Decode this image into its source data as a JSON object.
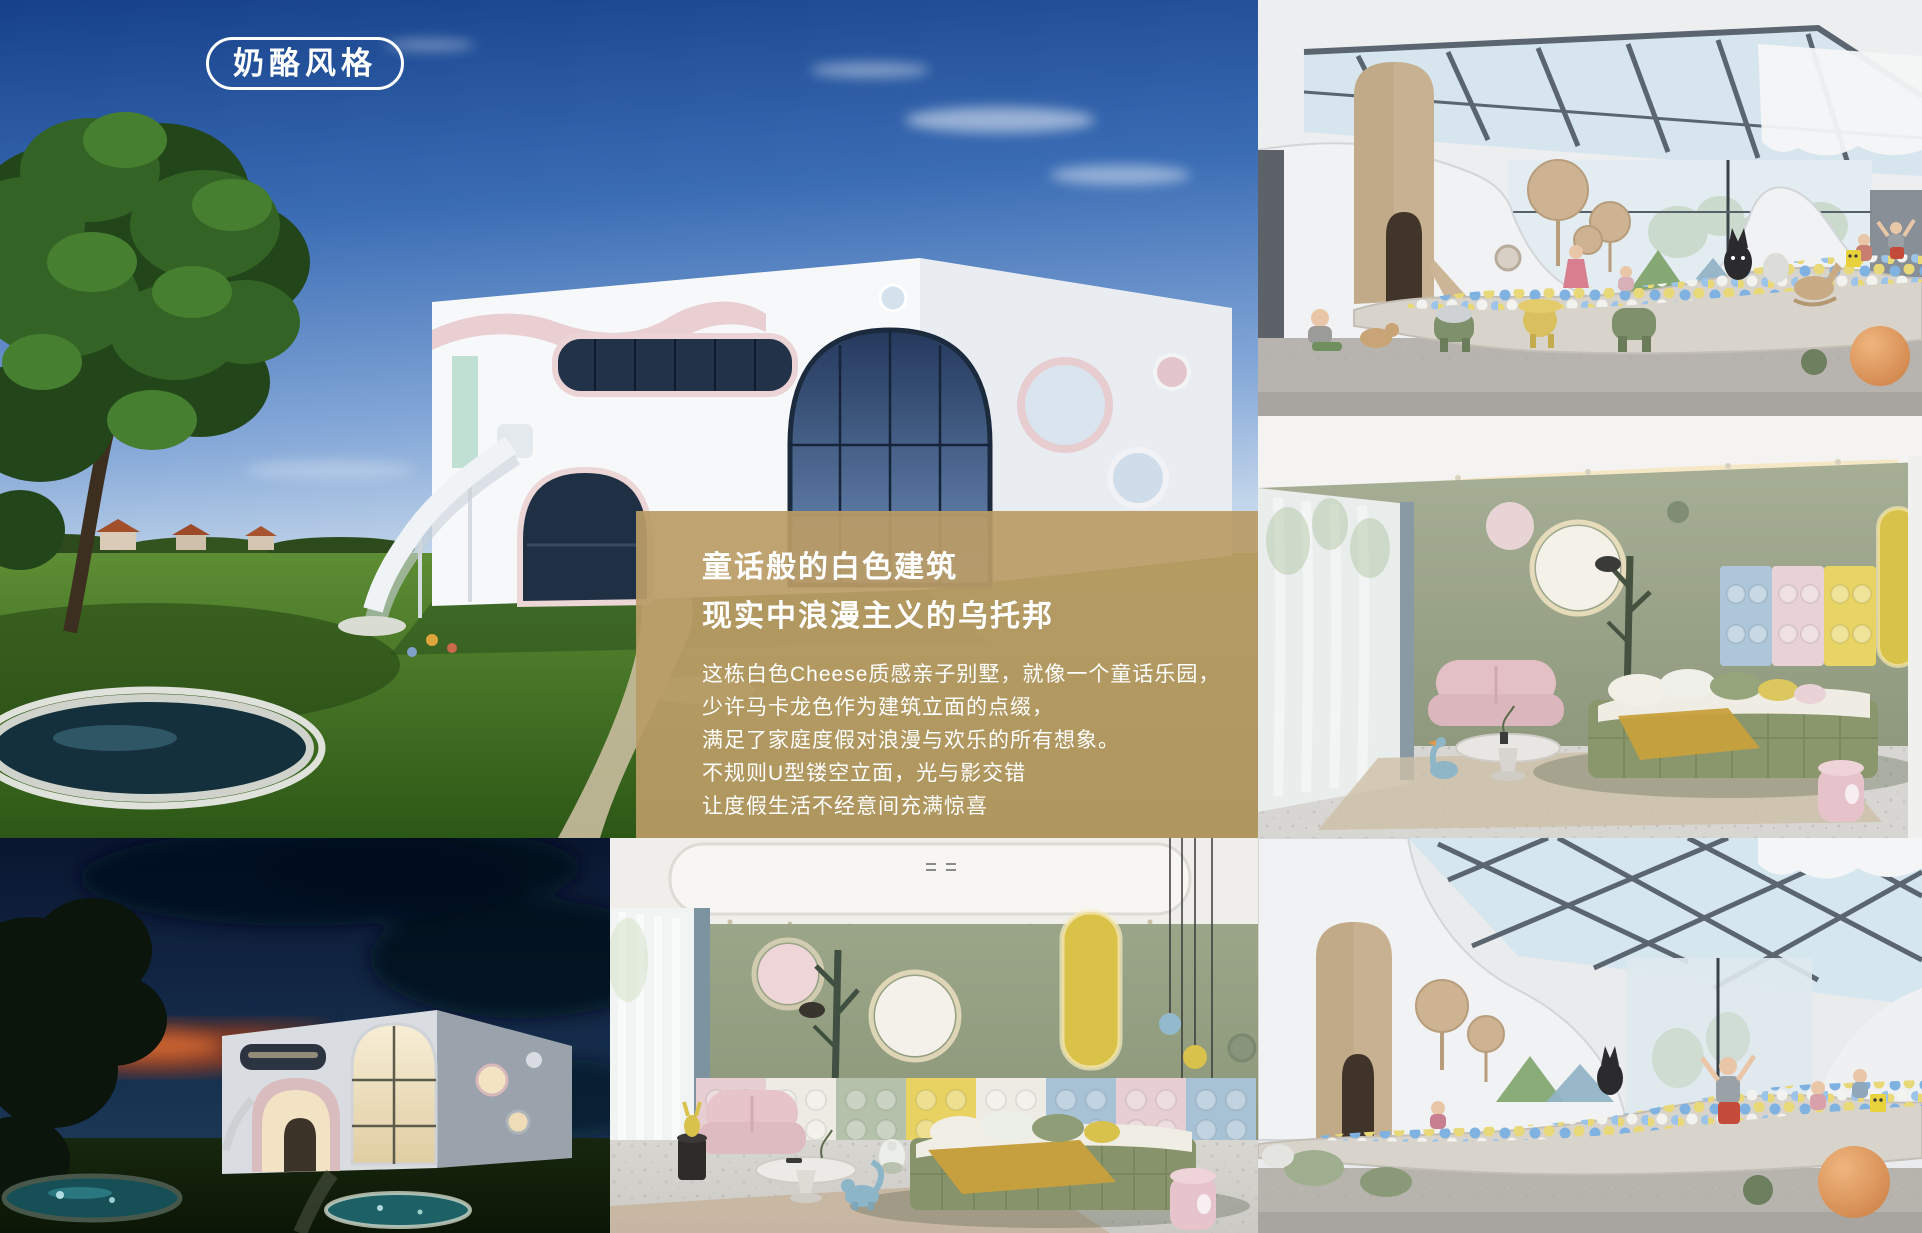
{
  "badge": {
    "label": "奶酪风格"
  },
  "overlay": {
    "title_line1": "童话般的白色建筑",
    "title_line2": "现实中浪漫主义的乌托邦",
    "body_lines": [
      "这栋白色Cheese质感亲子别墅，就像一个童话乐园，",
      "少许马卡龙色作为建筑立面的点缀，",
      "满足了家庭度假对浪漫与欢乐的所有想象。",
      "不规则U型镂空立面，光与影交错",
      "让度假生活不经意间充满惊喜"
    ],
    "background_color": "#BA9C66",
    "text_color": "#FFFFFF"
  },
  "badge_style": {
    "border_color": "#FFFFFF",
    "text_color": "#FFFFFF"
  },
  "palette": {
    "sky_blue": "#2D63B0",
    "sage_green": "#98A287",
    "pastel_pink": "#E8CFD3",
    "pastel_yellow": "#E8D262",
    "pastel_blue": "#A9C3D6",
    "wood_tan": "#C8B190"
  },
  "panels": {
    "main": "exterior-day-render",
    "top_right": "kids-playroom-ballpit",
    "mid_right": "green-bedroom-corner",
    "bottom_left": "exterior-night-render",
    "bottom_mid": "green-bedroom-front",
    "bottom_right": "kids-playroom-ballpit-wide"
  }
}
